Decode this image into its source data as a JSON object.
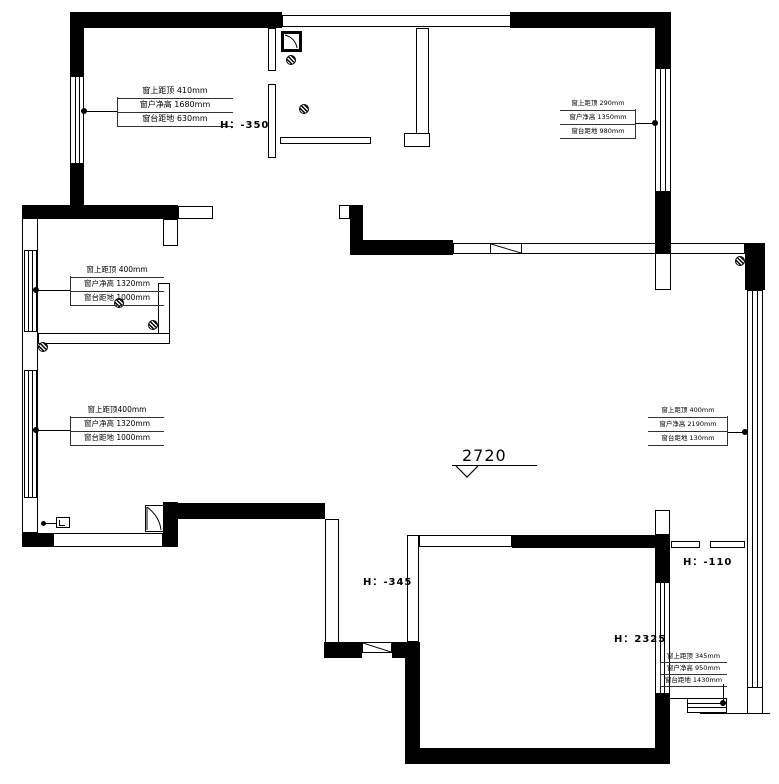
{
  "drawing": {
    "level_marker": "2720",
    "height_labels": {
      "hall": "H：-350",
      "entry": "H：-345",
      "balcony": "H：-110",
      "room": "H：2325"
    },
    "window_annotations": {
      "a1": {
        "rows": [
          "窗上距顶 410mm",
          "窗户净高 1680mm",
          "窗台距地 630mm"
        ]
      },
      "a2": {
        "rows": [
          "窗上距顶 290mm",
          "窗户净高 1350mm",
          "窗台距地 980mm"
        ]
      },
      "a3": {
        "rows": [
          "窗上距顶 400mm",
          "窗户净高 1320mm",
          "窗台距地 1000mm"
        ]
      },
      "a4": {
        "rows": [
          "窗上距顶400mm",
          "窗户净高 1320mm",
          "窗台距地 1000mm"
        ]
      },
      "a5": {
        "rows": [
          "窗上距顶 400mm",
          "窗户净高 2190mm",
          "窗台距地 130mm"
        ]
      },
      "a6": {
        "rows": [
          "窗上距顶 345mm",
          "窗户净高 950mm",
          "窗台距地 1430mm"
        ]
      }
    },
    "colors": {
      "ink": "#000000",
      "paper": "#ffffff"
    }
  }
}
